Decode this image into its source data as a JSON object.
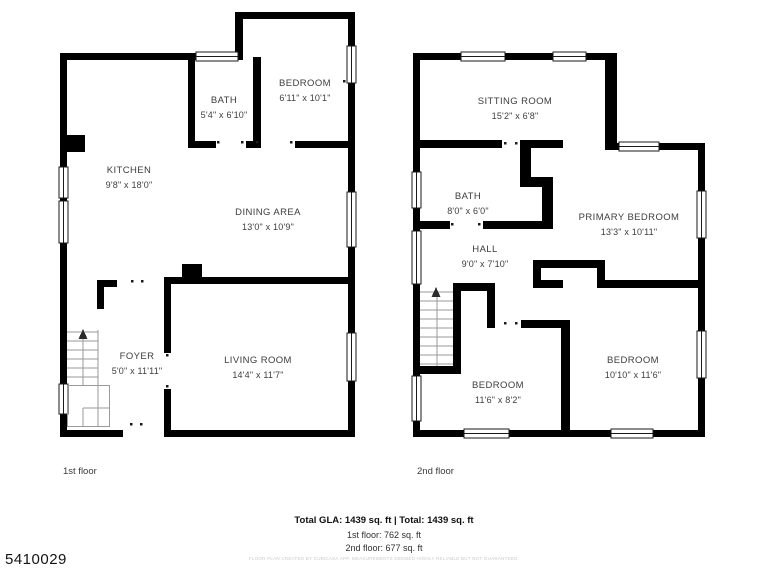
{
  "photo_id": "5410029",
  "floors": [
    {
      "caption": "1st floor",
      "rooms": [
        {
          "name": "KITCHEN",
          "dims": "9'8\" x 18'0\""
        },
        {
          "name": "BATH",
          "dims": "5'4\" x 6'10\""
        },
        {
          "name": "BEDROOM",
          "dims": "6'11\" x 10'1\""
        },
        {
          "name": "DINING AREA",
          "dims": "13'0\" x 10'9\""
        },
        {
          "name": "FOYER",
          "dims": "5'0\" x 11'11\""
        },
        {
          "name": "LIVING ROOM",
          "dims": "14'4\" x 11'7\""
        }
      ]
    },
    {
      "caption": "2nd floor",
      "rooms": [
        {
          "name": "SITTING ROOM",
          "dims": "15'2\" x 6'8\""
        },
        {
          "name": "BATH",
          "dims": "8'0\" x 6'0\""
        },
        {
          "name": "PRIMARY BEDROOM",
          "dims": "13'3\" x 10'11\""
        },
        {
          "name": "HALL",
          "dims": "9'0\" x 7'10\""
        },
        {
          "name": "BEDROOM",
          "dims": "11'6\" x 8'2\""
        },
        {
          "name": "BEDROOM",
          "dims": "10'10\" x 11'6\""
        }
      ]
    }
  ],
  "footer": {
    "total_line": "Total GLA: 1439 sq. ft | Total: 1439 sq. ft",
    "first_floor_line": "1st floor: 762 sq. ft",
    "second_floor_line": "2nd floor: 677 sq. ft",
    "disclaimer": "FLOOR PLAN CREATED BY CUBICASA APP. MEASUREMENTS DEEMED HIGHLY RELIABLE BUT NOT GUARANTEED."
  },
  "colors": {
    "wall": "#000000",
    "label_text": "#3d3d3d",
    "footer_text": "#111111",
    "disclaimer_text": "#c9c9c9"
  }
}
